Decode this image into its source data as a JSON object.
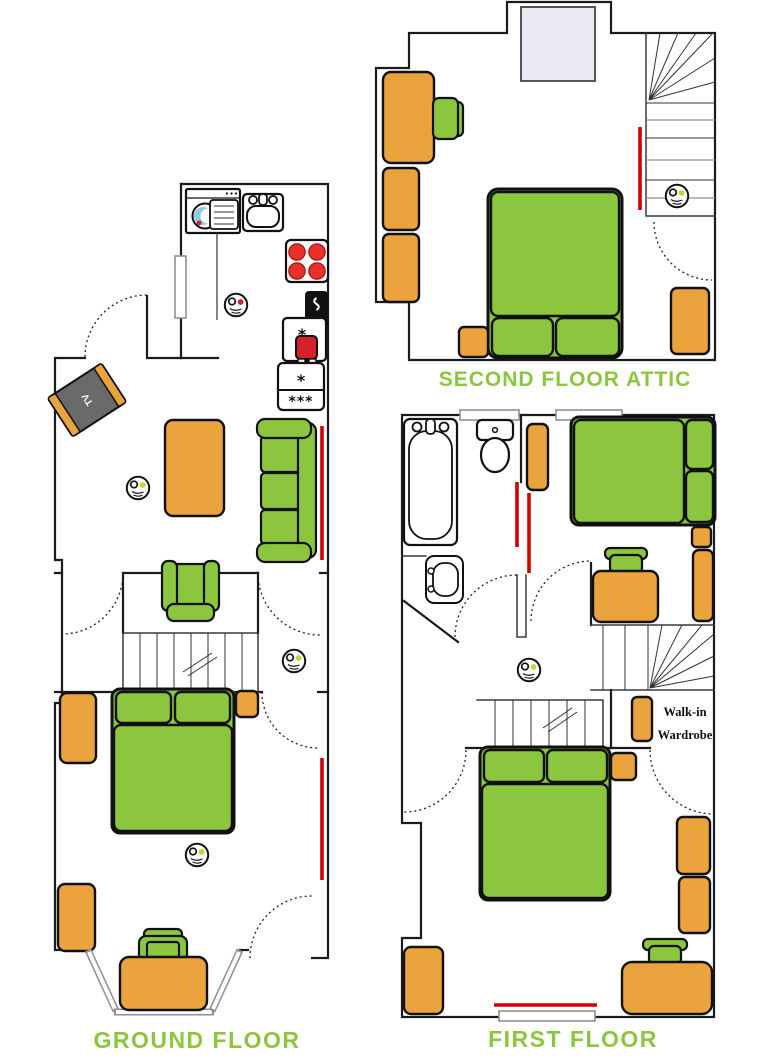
{
  "colors": {
    "furniture_green": "#8CC63F",
    "furniture_orange": "#EBA33D",
    "wall_dark": "#1B1B1B",
    "radiator_red": "#D40000",
    "burner_red": "#E8312A",
    "alarm_red_dot": "#D5222A",
    "alarm_green_dot": "#BFD730",
    "label_green": "#8CC63F",
    "tv_gray": "#6A6A6A",
    "skylight_blue": "#E9EAF5",
    "window_gray": "#8A9099"
  },
  "labels": {
    "ground": "GROUND FLOOR",
    "first": "FIRST FLOOR",
    "attic": "SECOND FLOOR ATTIC",
    "walk_in_line1": "Walk-in",
    "walk_in_line2": "Wardrobe",
    "tv": "TV",
    "fridge_compartment": "*",
    "freezer_compartment": "***",
    "appliance_star": "*"
  },
  "alarms": {
    "ground_kitchen_dot": "red",
    "ground_living_dot": "green",
    "ground_hall_dot": "green",
    "ground_bedroom_dot": "green",
    "first_landing_dot": "green",
    "attic_stairs_dot": "green"
  },
  "furniture_icons": {
    "ground": [
      "washing-machine",
      "kitchen-sink",
      "hob",
      "oven",
      "fridge-freezer",
      "tv-unit",
      "coffee-table",
      "sofa",
      "armchair",
      "double-bed",
      "bedside-table",
      "wardrobe",
      "desk",
      "chair",
      "bay-window",
      "radiator",
      "stairs"
    ],
    "first": [
      "bath",
      "toilet",
      "wash-basin",
      "wardrobe",
      "double-bed",
      "desk",
      "chair",
      "bedside-table",
      "walk-in-wardrobe-unit",
      "radiator",
      "stairs",
      "window"
    ],
    "attic": [
      "skylight",
      "desk",
      "chair",
      "wardrobe",
      "double-bed",
      "bedside-table",
      "rug",
      "radiator",
      "stairs"
    ]
  }
}
